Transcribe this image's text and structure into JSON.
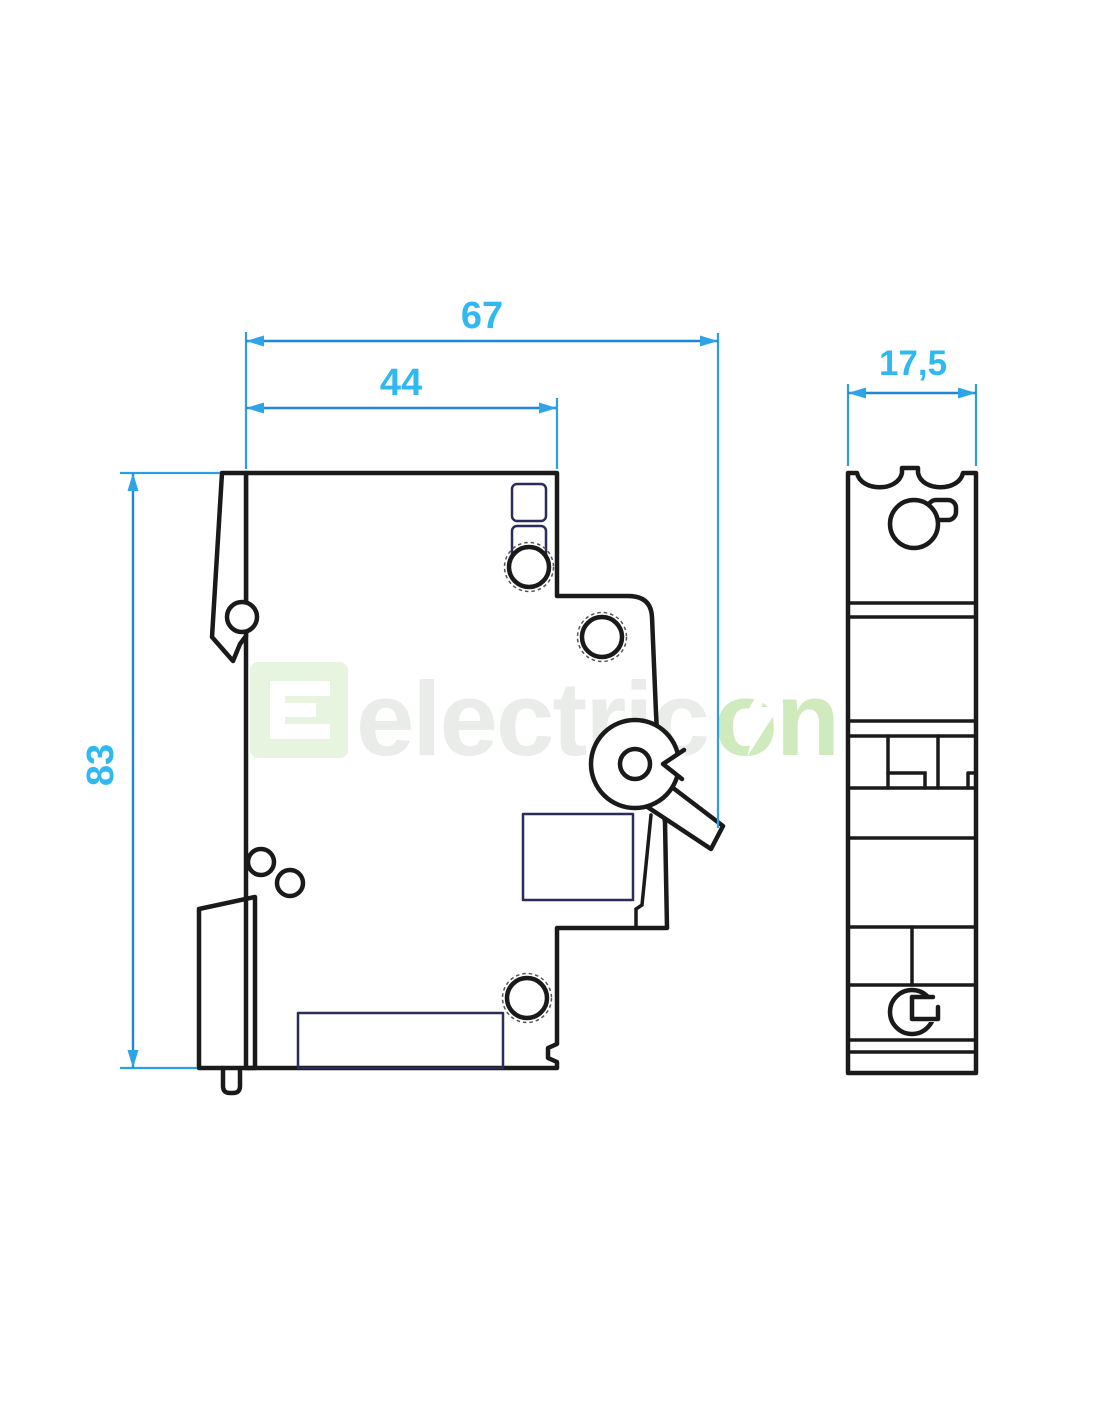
{
  "drawing": {
    "type": "technical-dimension-drawing",
    "subject": "miniature-circuit-breaker-side-and-front-views",
    "dimensions": {
      "overall_depth": "67",
      "body_depth": "44",
      "height": "83",
      "width": "17,5"
    },
    "colors": {
      "background": "#ffffff",
      "outline": "#1a1a1a",
      "detail_line": "#2c2c5a",
      "dimension_line": "#2185d8",
      "dimension_arrow": "#2da4e8",
      "dimension_text": "#2fb9f0",
      "watermark_gray": "#e9ece8",
      "watermark_green": "#cfeabc",
      "watermark_logo_green": "#e7f4df"
    },
    "watermark": {
      "text_gray": "electric",
      "text_green": "on"
    }
  }
}
